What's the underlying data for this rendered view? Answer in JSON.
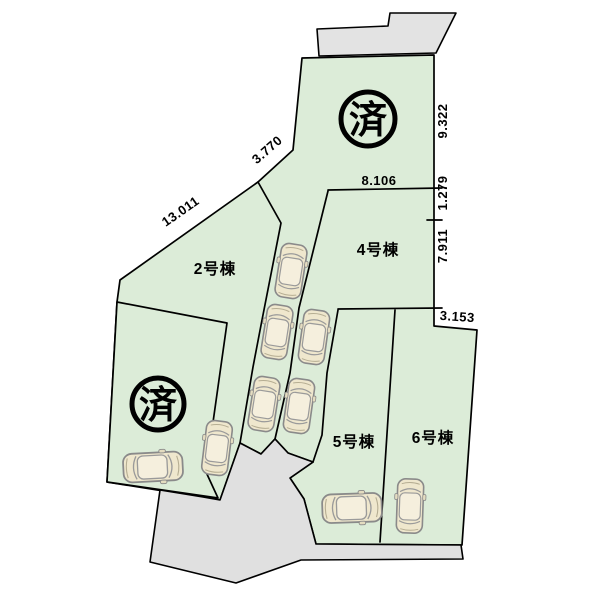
{
  "diagram": {
    "lots": [
      {
        "label": "2号棟"
      },
      {
        "label": "4号棟"
      },
      {
        "label": "5号棟"
      },
      {
        "label": "6号棟"
      }
    ],
    "sold_marks": [
      {
        "label": "済"
      },
      {
        "label": "済"
      }
    ],
    "dimensions": [
      {
        "label": "13.011"
      },
      {
        "label": "3.770"
      },
      {
        "label": "8.106"
      },
      {
        "label": "9.322"
      },
      {
        "label": "1.279"
      },
      {
        "label": "7.911"
      },
      {
        "label": "3.153"
      }
    ],
    "colors": {
      "lot_green": "#dcecd8",
      "road_gray": "#e3e3e3",
      "outline": "#000000",
      "car_body": "#efe7cd",
      "car_cabin": "#f5efdd"
    }
  }
}
